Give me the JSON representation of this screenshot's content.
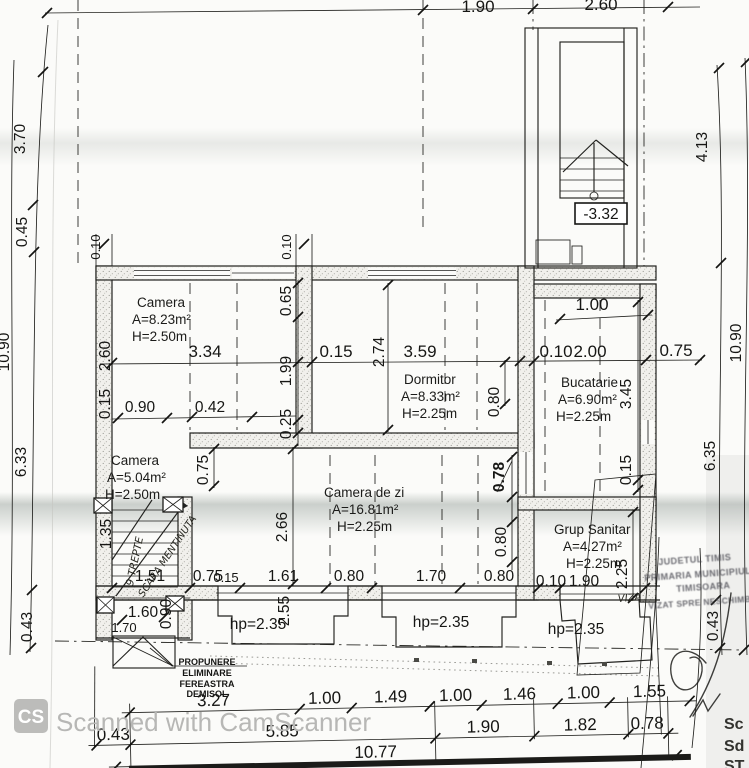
{
  "scan": {
    "watermark": {
      "badge": "CS",
      "text": "Scanned with CamScanner"
    },
    "edge_labels": [
      "Sc",
      "Sd",
      "ST"
    ]
  },
  "plan": {
    "rooms": [
      {
        "name": "Camera",
        "area": "A=8.23m²",
        "height": "H=2.50m"
      },
      {
        "name": "Dormitor",
        "area": "A=8.33m²",
        "height": "H=2.25m"
      },
      {
        "name": "Bucatarie",
        "area": "A=6.90m²",
        "height": "H=2.25m"
      },
      {
        "name": "Camera",
        "area": "A=5.04m²",
        "height": "H=2.50m"
      },
      {
        "name": "Camera de zi",
        "area": "A=16.81m²",
        "height": "H=2.25m"
      },
      {
        "name": "Grup Sanitar",
        "area": "A=4.27m²",
        "height": "H=2.25m"
      }
    ],
    "stair_level": "-3.32",
    "parapet_labels": [
      "hp=2.35",
      "hp=2.35",
      "hp=2.35"
    ],
    "notes": {
      "proposal": [
        "PROPUNERE",
        "ELIMINARE",
        "FEREASTRA",
        "DEMISOL"
      ],
      "stair_note_a": "9 TREPTE",
      "stair_note_b": "SCARA MENTINUTA"
    },
    "stamp": {
      "line1": "JUDETUL TIMIS",
      "line2": "PRIMARIA MUNICIPIULUI",
      "line3": "TIMISOARA",
      "line4": "VIZAT SPRE NESCHIMBARE",
      "handwriting": "VIZA"
    },
    "dims": {
      "top": [
        "1.90",
        "2.60"
      ],
      "left": [
        "3.70",
        "0.45",
        "10.90",
        "6.33",
        "0.43"
      ],
      "right": [
        "4.13",
        "10.90",
        "6.35",
        "0.43"
      ],
      "wall_thickness": [
        "0.10",
        "0.10"
      ],
      "row_main": [
        "3.34",
        "0.15",
        "3.59",
        "0.10",
        "2.00",
        "0.75"
      ],
      "row_upper": [
        "0.90",
        "0.42"
      ],
      "row_lower": [
        "1.51",
        "0.75",
        "0.15",
        "1.61",
        "0.80",
        "1.70",
        "0.80",
        "0.10",
        "1.90"
      ],
      "col_left_wall": [
        "2.60",
        "0.15"
      ],
      "col_partition": [
        "0.65",
        "1.99",
        "0.25"
      ],
      "col_dormitor": [
        "2.74",
        "0.80"
      ],
      "col_kitchen": [
        "3.45",
        "0.15"
      ],
      "kitchen_top": "1.00",
      "col_living": [
        "0.75",
        "2.66",
        "0.78",
        "0.80"
      ],
      "col_stair": [
        "1.35",
        "0.90",
        "2.55"
      ],
      "col_sanitar": [
        "2.25"
      ],
      "stair_row": [
        "1.60",
        "1.70"
      ],
      "bottom_row1": [
        "3.27",
        "1.00",
        "1.49",
        "1.00",
        "1.46",
        "1.00",
        "1.55"
      ],
      "bottom_row2": [
        "0.43",
        "5.85",
        "1.90",
        "1.82",
        "0.78"
      ],
      "bottom_total": "10.77"
    }
  }
}
